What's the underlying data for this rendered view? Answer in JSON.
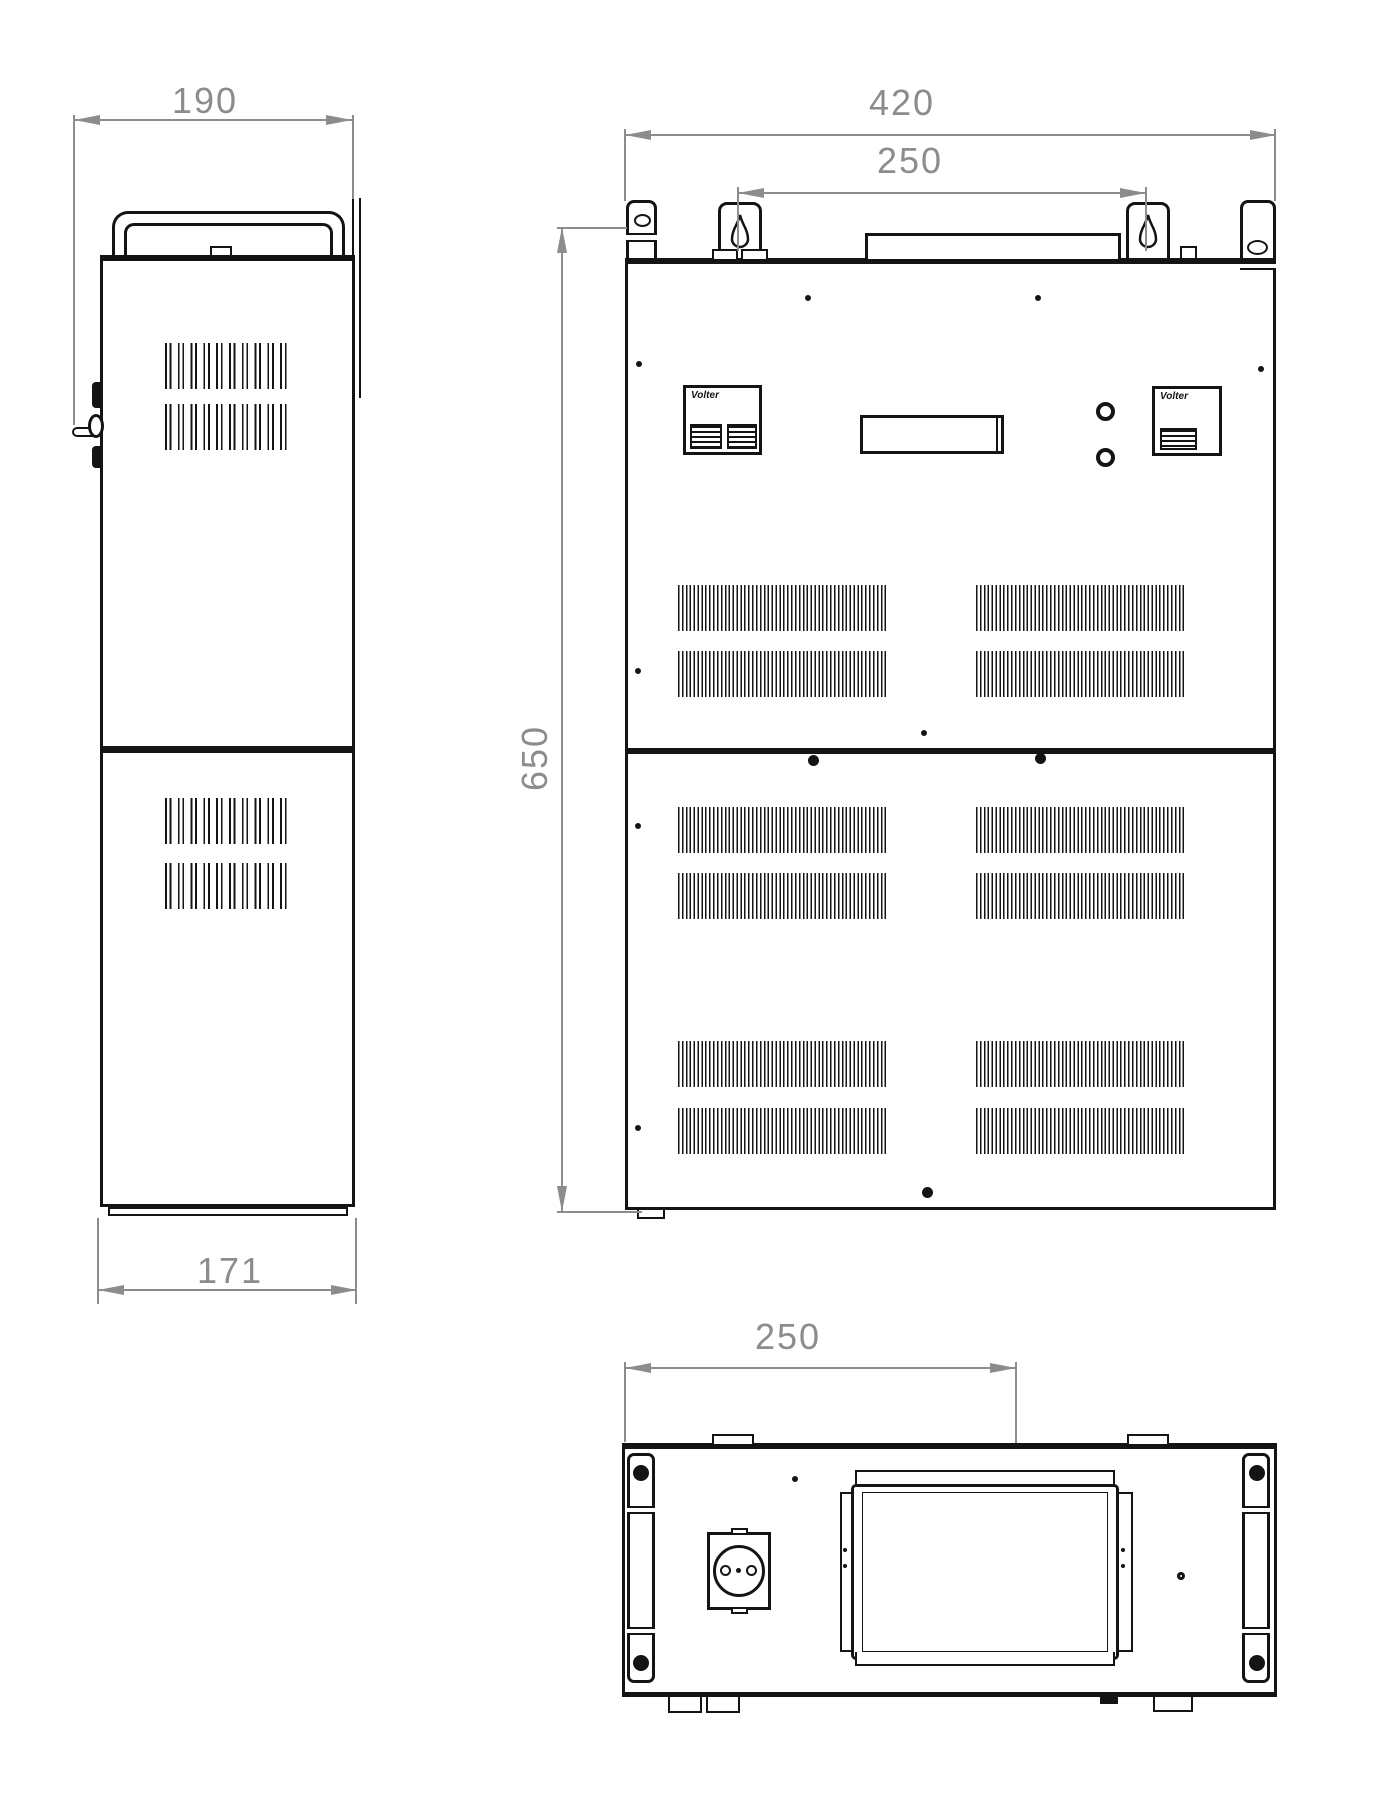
{
  "drawing": {
    "side": {
      "dim_width": "190",
      "dim_depth": "171"
    },
    "front": {
      "dim_width": "420",
      "dim_mount_span": "250",
      "dim_height": "650",
      "brand": "Volter"
    },
    "bottom": {
      "dim_mount_span": "250"
    },
    "colors": {
      "line": "#141414",
      "dimension": "#8c8c8c",
      "background": "#ffffff"
    }
  }
}
